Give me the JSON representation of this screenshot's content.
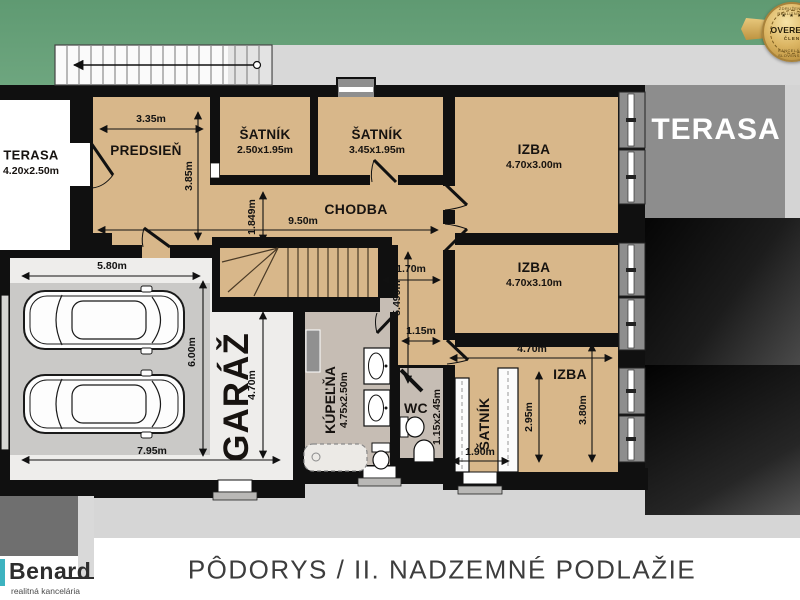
{
  "title": "PÔDORYS / II. NADZEMNÉ PODLAŽIE",
  "rooms": {
    "terasa_left": {
      "label": "TERASA",
      "dims": "4.20x2.50m"
    },
    "predsien": {
      "label": "PREDSIEŇ"
    },
    "satnik_a": {
      "label": "ŠATNÍK",
      "dims": "2.50x1.95m"
    },
    "satnik_b": {
      "label": "ŠATNÍK",
      "dims": "3.45x1.95m"
    },
    "chodba": {
      "label": "CHODBA"
    },
    "izba_a": {
      "label": "IZBA",
      "dims": "4.70x3.00m"
    },
    "izba_b": {
      "label": "IZBA",
      "dims": "4.70x3.10m"
    },
    "izba_c": {
      "label": "IZBA"
    },
    "satnik_c": {
      "label": "ŠATNÍK"
    },
    "wc": {
      "label": "WC",
      "dims": "1.15x2.45m"
    },
    "kupelna": {
      "label": "KÚPEĽŇA",
      "dims": "4.75x2.50m"
    },
    "garaz": {
      "label": "GARÁŽ"
    },
    "terasa_right": {
      "label": "TERASA"
    }
  },
  "dims": {
    "predsien_width": "3.35m",
    "predsien_height": "3.85m",
    "chodba_length": "9.50m",
    "chodba_width": "1.849m",
    "corridor_width": "1.70m",
    "corridor_length": "5.499m",
    "corridor_narrow": "1.15m",
    "garage_width_top": "5.80m",
    "garage_height": "6.00m",
    "garage_inner_height": "4.70m",
    "garage_width_bottom": "7.95m",
    "izba_c_width": "4.70m",
    "izba_c_inner_height": "2.95m",
    "izba_c_height": "3.80m",
    "satnik_c_width": "1.90m"
  },
  "brand": {
    "name": "Benard",
    "tagline": "realitná kancelária"
  },
  "badge": {
    "stars": "★ ★ ★",
    "label": "OVERENÝ",
    "member": "ČLEN",
    "ring_top": "ZDRUŽENIE REALITNÝCH",
    "ring_bottom": "KANCELÁRIÍ SLOVENSKA"
  },
  "colors": {
    "grass": "#68a17a",
    "plaza": "#d8d8d8",
    "floor_tan": "#d8b78a",
    "floor_bath": "#c6bdb4",
    "garage_floor": "#cac9c7",
    "wall": "#101010",
    "terasa_right": "#8d8d8d",
    "accent_teal": "#3db3c0",
    "badge_gold": "#d4ab55"
  }
}
